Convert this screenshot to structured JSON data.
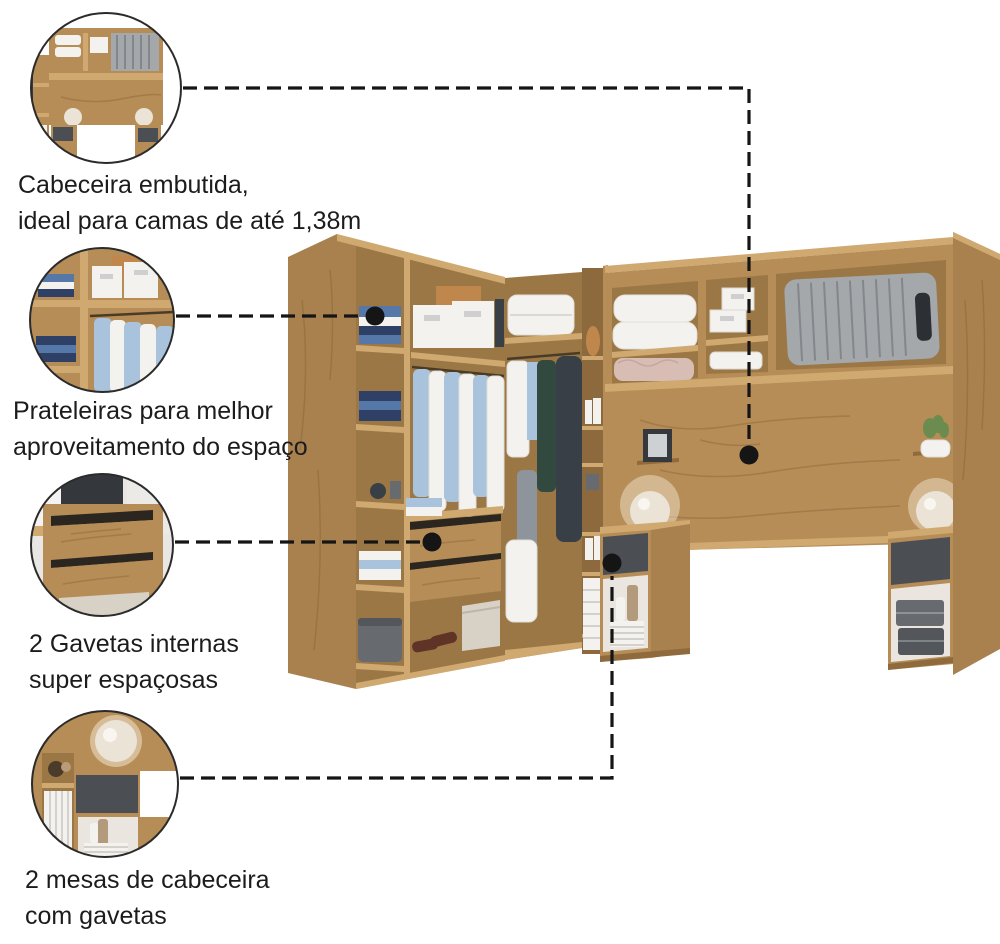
{
  "callouts": [
    {
      "feature": "built-in-headboard",
      "label_lines": [
        "Cabeceira embutida,",
        "ideal para camas de até 1,38m"
      ]
    },
    {
      "feature": "space-saving-shelves",
      "label_lines": [
        "Prateleiras para melhor",
        "aproveitamento do espaço"
      ]
    },
    {
      "feature": "internal-drawers",
      "label_lines": [
        "2 Gavetas internas",
        "super espaçosas"
      ]
    },
    {
      "feature": "nightstands-with-drawers",
      "label_lines": [
        "2 mesas de cabeceira",
        "com gavetas"
      ]
    }
  ],
  "colors": {
    "bg": "#ffffff",
    "ink": "#1c1c1c",
    "line": "#151515",
    "wood": "#b68c57",
    "wood-light": "#cfa96f",
    "wood-dark": "#8f6a3c",
    "wood-side": "#a8814e",
    "interior": "#9c7746",
    "grain": "#7d5b31",
    "drawer-gray": "#4b4f54",
    "box-gray": "#676b70",
    "white-soft": "#f3f2ef",
    "blue-shirt": "#a9c3dd",
    "blue-fold": "#5578a8",
    "navy": "#2e4066",
    "teal": "#31493f",
    "garment": "#383f46",
    "suitcase": "#a4a8ab",
    "suitcase-dark": "#83878b",
    "tan-box": "#c0874c",
    "pink": "#d8bdb4",
    "lamp": "#eae3d6",
    "shoe": "#5f3326",
    "beige": "#d8d1c6",
    "green": "#6b8c4e"
  }
}
